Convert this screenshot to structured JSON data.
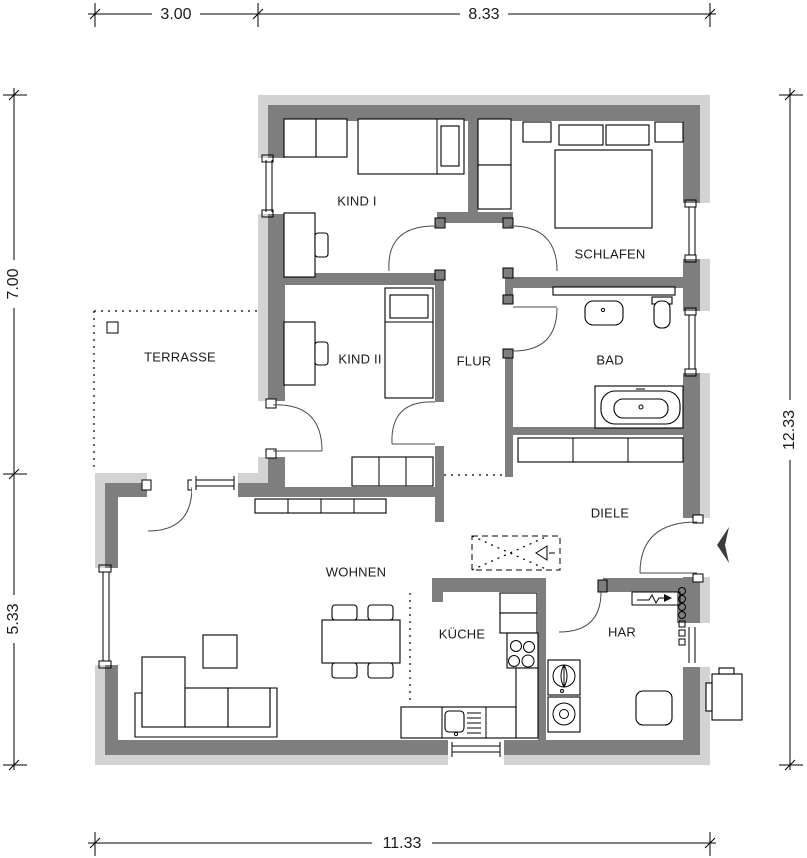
{
  "title": "Grundriss Bungalow",
  "colors": {
    "wall_dark": "#7e7e7e",
    "wall_light": "#d3d3d3",
    "line": "#000000",
    "bg": "#ffffff"
  },
  "rooms": [
    {
      "id": "kind1",
      "label": "KIND I"
    },
    {
      "id": "schlafen",
      "label": "SCHLAFEN"
    },
    {
      "id": "kind2",
      "label": "KIND II"
    },
    {
      "id": "flur",
      "label": "FLUR"
    },
    {
      "id": "bad",
      "label": "BAD"
    },
    {
      "id": "terrasse",
      "label": "TERRASSE"
    },
    {
      "id": "diele",
      "label": "DIELE"
    },
    {
      "id": "wohnen",
      "label": "WOHNEN"
    },
    {
      "id": "kueche",
      "label": "KÜCHE"
    },
    {
      "id": "har",
      "label": "HAR"
    }
  ],
  "dimensions": {
    "top": [
      {
        "label": "3.00"
      },
      {
        "label": "8.33"
      }
    ],
    "left": [
      {
        "label": "7.00"
      },
      {
        "label": "5.33"
      }
    ],
    "right": [
      {
        "label": "12.33"
      }
    ],
    "bottom": [
      {
        "label": "11.33"
      }
    ]
  },
  "symbols": {
    "entrance_arrow": "left-chevron",
    "electric_connection": "lightning-arrow",
    "loft_hatch": "dashed-cross-with-triangle"
  }
}
